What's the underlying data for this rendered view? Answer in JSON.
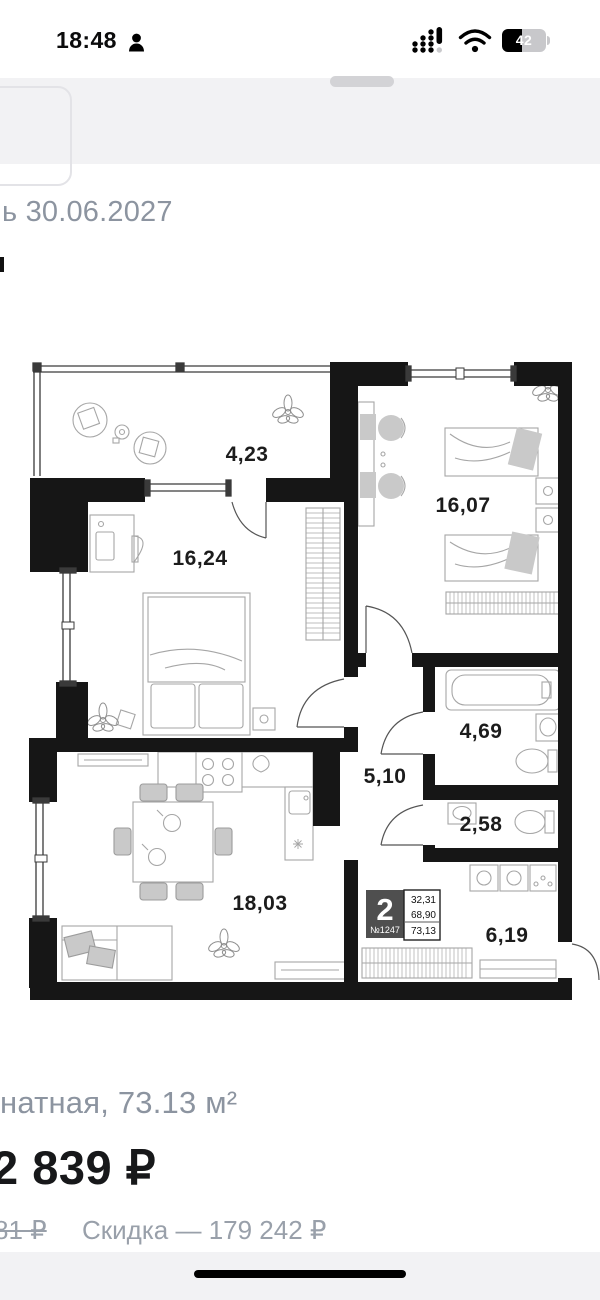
{
  "status_bar": {
    "time": "18:48",
    "battery_level": "42"
  },
  "sheet_header": {
    "date_fragment": "ь 30.06.2027"
  },
  "floor_plan": {
    "unit_badge": {
      "rooms": "2",
      "number": "№1247",
      "areas": [
        "32,31",
        "68,90",
        "73,13"
      ]
    },
    "rooms": [
      {
        "name": "balcony",
        "area": "4,23"
      },
      {
        "name": "bedroom-1",
        "area": "16,24"
      },
      {
        "name": "bedroom-2",
        "area": "16,07"
      },
      {
        "name": "bathroom",
        "area": "4,69"
      },
      {
        "name": "hallway",
        "area": "5,10"
      },
      {
        "name": "wc",
        "area": "2,58"
      },
      {
        "name": "kitchen-living",
        "area": "18,03"
      },
      {
        "name": "entry",
        "area": "6,19"
      }
    ]
  },
  "listing": {
    "title_fragment": "натная, 73.13 м²",
    "price_fragment": "2 839 ₽",
    "old_price_fragment": "81 ₽",
    "discount_text": "Скидка — 179 242 ₽"
  },
  "colors": {
    "muted_text": "#8c94a0",
    "band": "#f2f2f4",
    "wall": "#161616",
    "badge": "#4f4f4f"
  }
}
